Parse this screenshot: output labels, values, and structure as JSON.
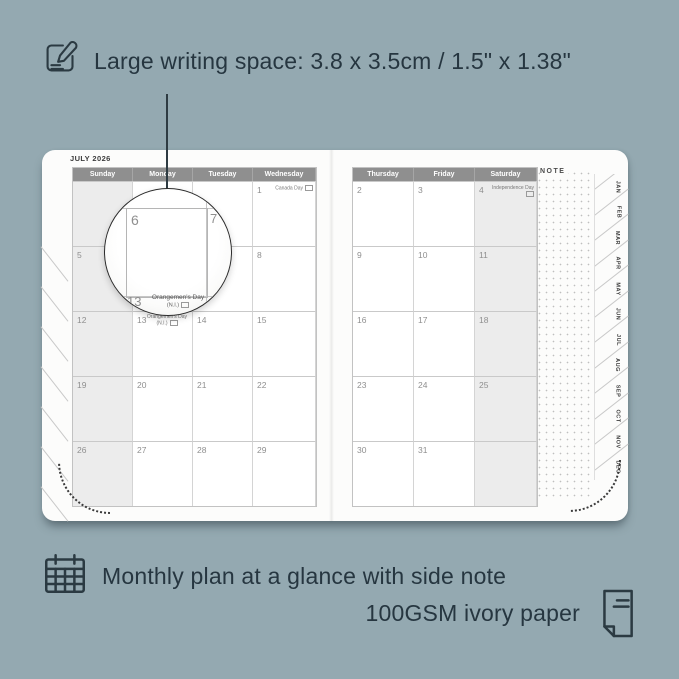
{
  "colors": {
    "background": "#94a9b1",
    "ink": "#2b3a42",
    "paper": "#fcfcfb",
    "weekday_header_bar": "#8f8f8f",
    "weekend_shade": "#ececec"
  },
  "annotations": {
    "top": {
      "icon": "pencil-note-icon",
      "text": "Large writing space: 3.8 x 3.5cm / 1.5\" x 1.38\""
    },
    "bottom": {
      "icon_left": "calendar-grid-icon",
      "line1": "Monthly plan at a glance with side note",
      "line2": "100GSM ivory paper",
      "icon_right": "paper-icon"
    }
  },
  "planner": {
    "month_title": "JULY 2026",
    "note_label": "NOTE",
    "left_page": {
      "headers": [
        "Sunday",
        "Monday",
        "Tuesday",
        "Wednesday"
      ],
      "weekend_col": 0,
      "cells": [
        {
          "day": ""
        },
        {
          "day": ""
        },
        {
          "day": ""
        },
        {
          "day": "1",
          "holiday": "Canada Day"
        },
        {
          "day": "5"
        },
        {
          "day": "6"
        },
        {
          "day": "7"
        },
        {
          "day": "8"
        },
        {
          "day": "12"
        },
        {
          "day": "13",
          "holiday": "Orangemen's Day",
          "holiday2": "(N.I.)"
        },
        {
          "day": "14"
        },
        {
          "day": "15"
        },
        {
          "day": "19"
        },
        {
          "day": "20"
        },
        {
          "day": "21"
        },
        {
          "day": "22"
        },
        {
          "day": "26"
        },
        {
          "day": "27"
        },
        {
          "day": "28"
        },
        {
          "day": "29"
        }
      ]
    },
    "right_page": {
      "headers": [
        "Thursday",
        "Friday",
        "Saturday"
      ],
      "weekend_col": 2,
      "cells": [
        {
          "day": "2"
        },
        {
          "day": "3"
        },
        {
          "day": "4",
          "holiday": "Independence Day"
        },
        {
          "day": "9"
        },
        {
          "day": "10"
        },
        {
          "day": "11"
        },
        {
          "day": "16"
        },
        {
          "day": "17"
        },
        {
          "day": "18"
        },
        {
          "day": "23"
        },
        {
          "day": "24"
        },
        {
          "day": "25"
        },
        {
          "day": "30"
        },
        {
          "day": "31"
        },
        {
          "day": ""
        }
      ]
    },
    "month_tabs": [
      "JAN",
      "FEB",
      "MAR",
      "APR",
      "MAY",
      "JUN",
      "JUL",
      "AUG",
      "SEP",
      "OCT",
      "NOV",
      "DEC"
    ]
  },
  "magnifier": {
    "day_main": "6",
    "day_next": "7",
    "day_below": "13",
    "holiday": "Orangemen's Day",
    "holiday_region": "(N.I.)"
  }
}
